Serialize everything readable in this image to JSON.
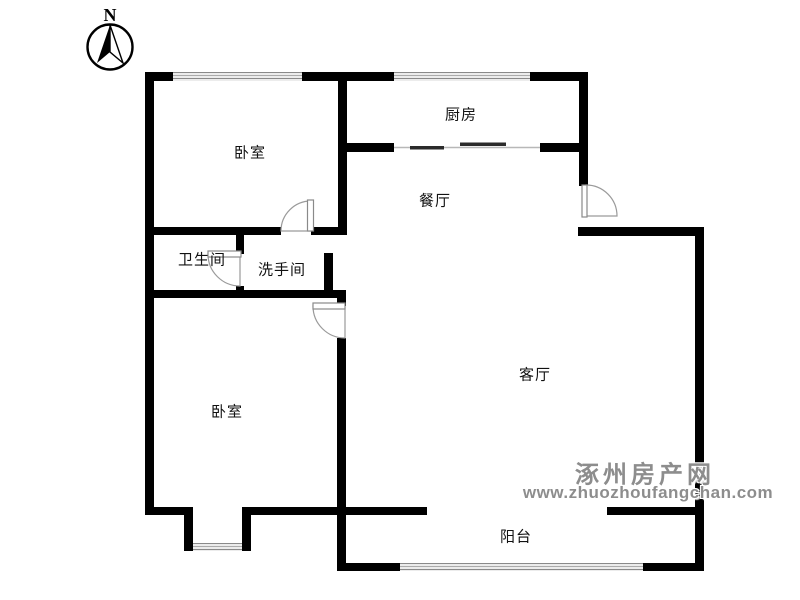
{
  "compass": {
    "label": "N"
  },
  "rooms": [
    {
      "id": "bedroom-top",
      "label": "卧室"
    },
    {
      "id": "kitchen",
      "label": "厨房"
    },
    {
      "id": "dining",
      "label": "餐厅"
    },
    {
      "id": "bathroom",
      "label": "卫生间"
    },
    {
      "id": "washroom",
      "label": "洗手间"
    },
    {
      "id": "living",
      "label": "客厅"
    },
    {
      "id": "bedroom-bottom",
      "label": "卧室"
    },
    {
      "id": "balcony",
      "label": "阳台"
    }
  ],
  "watermark": {
    "site_name": "涿州房产网",
    "site_url": "www.zhuozhoufangchan.com"
  },
  "colors": {
    "wall": "#000000",
    "door_stroke": "#9a9a9a",
    "window_line": "#8a8a8a",
    "label_text": "#111111",
    "watermark_text": "#8d8d8d"
  }
}
